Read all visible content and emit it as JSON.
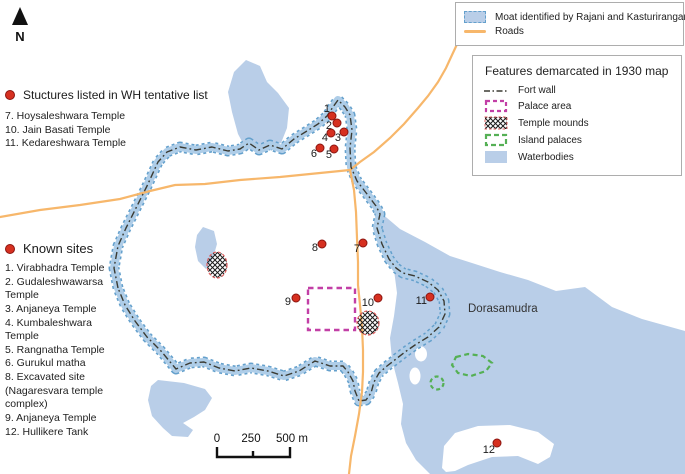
{
  "north_indicator": {
    "label": "N"
  },
  "legend_moat_roads": {
    "items": [
      {
        "icon": "moat-swatch",
        "label": "Moat identified by Rajani and Kasturirangan"
      },
      {
        "icon": "road-line",
        "label": "Roads"
      }
    ]
  },
  "legend_1930": {
    "title": "Features demarcated in 1930 map",
    "items": [
      {
        "icon": "fort-wall-line",
        "label": "Fort wall"
      },
      {
        "icon": "palace-area-swatch",
        "label": "Palace area"
      },
      {
        "icon": "temple-mounds-swatch",
        "label": "Temple mounds"
      },
      {
        "icon": "island-palaces-swatch",
        "label": "Island palaces"
      },
      {
        "icon": "waterbodies-swatch",
        "label": "Waterbodies"
      }
    ]
  },
  "wh_list": {
    "title": "Stuctures listed in WH tentative list",
    "items": [
      "7. Hoysaleshwara Temple",
      "10. Jain Basati Temple",
      "11. Kedareshwara Temple"
    ]
  },
  "known_sites": {
    "title": "Known sites",
    "items": [
      "1. Virabhadra Temple",
      "2. Gudaleshwawarsa Temple",
      "3. Anjaneya Temple",
      "4. Kumbaleshwara Temple",
      "5. Rangnatha Temple",
      "6. Gurukul matha",
      "8. Excavated site (Nagaresvara temple complex)",
      "9. Anjaneya Temple",
      "12. Hullikere Tank"
    ]
  },
  "map": {
    "lake_label": "Dorasamudra",
    "scale_bar": {
      "labels": [
        "0",
        "250",
        "500 m"
      ]
    },
    "site_markers": [
      {
        "n": "1",
        "x": 332,
        "y": 116,
        "lx": 330,
        "ly": 112
      },
      {
        "n": "2",
        "x": 337,
        "y": 123,
        "lx": 332,
        "ly": 129
      },
      {
        "n": "3",
        "x": 344,
        "y": 132,
        "lx": 341,
        "ly": 141
      },
      {
        "n": "4",
        "x": 331,
        "y": 133,
        "lx": 328,
        "ly": 141
      },
      {
        "n": "5",
        "x": 334,
        "y": 149,
        "lx": 332,
        "ly": 158
      },
      {
        "n": "6",
        "x": 320,
        "y": 148,
        "lx": 317,
        "ly": 157
      },
      {
        "n": "7",
        "x": 363,
        "y": 243,
        "lx": 360,
        "ly": 252
      },
      {
        "n": "8",
        "x": 322,
        "y": 244,
        "lx": 318,
        "ly": 251
      },
      {
        "n": "9",
        "x": 296,
        "y": 298,
        "lx": 291,
        "ly": 305
      },
      {
        "n": "10",
        "x": 378,
        "y": 298,
        "lx": 374,
        "ly": 306
      },
      {
        "n": "11",
        "x": 430,
        "y": 297,
        "lx": 427,
        "ly": 304
      },
      {
        "n": "12",
        "x": 497,
        "y": 443,
        "lx": 495,
        "ly": 453
      }
    ]
  },
  "colors": {
    "waterbody": "#b9cee8",
    "moat_edge": "#64a0cc",
    "road": "#f7b76b",
    "fort_wall": "#3b3b33",
    "palace_area": "#c23fa6",
    "island_palaces": "#55b055",
    "temple_mound_outline": "#e06060",
    "site_marker": "#d63020"
  }
}
